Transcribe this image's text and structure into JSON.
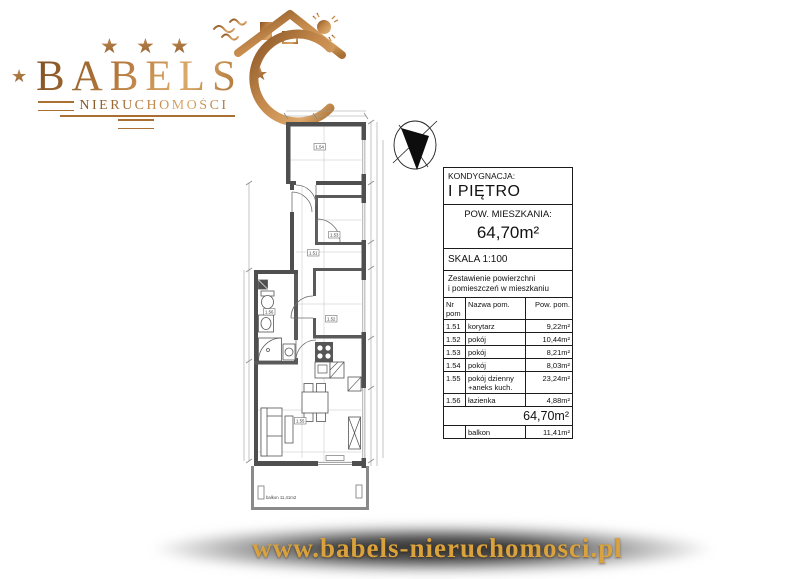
{
  "logo": {
    "brand": "BABELS",
    "subtitle": "NIERUCHOMOŚCI",
    "star": "★"
  },
  "info_panel": {
    "kondygnacja_label": "KONDYGNACJA:",
    "kondygnacja_value": "I PIĘTRO",
    "pow_label": "POW. MIESZKANIA:",
    "pow_value": "64,70m²",
    "skala": "SKALA 1:100",
    "zestawienie_line1": "Zestawienie powierzchni",
    "zestawienie_line2": "i pomieszczeń w mieszkaniu",
    "table": {
      "headers": [
        "Nr pom",
        "Nazwa pom.",
        "Pow. pom."
      ],
      "rows": [
        {
          "nr": "1.51",
          "nazwa": "korytarz",
          "pow": "9,22m²"
        },
        {
          "nr": "1.52",
          "nazwa": "pokój",
          "pow": "10,44m²"
        },
        {
          "nr": "1.53",
          "nazwa": "pokój",
          "pow": "8,21m²"
        },
        {
          "nr": "1.54",
          "nazwa": "pokój",
          "pow": "8,03m²"
        },
        {
          "nr": "1.55",
          "nazwa": "pokój dzienny\n+aneks kuch.",
          "pow": "23,24m²"
        },
        {
          "nr": "1.56",
          "nazwa": "łazienka",
          "pow": "4,88m²"
        }
      ],
      "total": "64,70m²",
      "balkon_row": {
        "nr": "",
        "nazwa": "balkon",
        "pow": "11,41m²"
      }
    }
  },
  "plan": {
    "labels": {
      "room_top": "1.54",
      "room_153": "1.53",
      "corridor": "1.51",
      "room_152": "1.52",
      "bathroom": "1.56",
      "living": "1.55"
    },
    "balkon_label": "balkon 11,41m2"
  },
  "footer": {
    "url": "www.babels-nieruchomosci.pl"
  },
  "colors": {
    "gold": "#b5793c",
    "wall": "#4f4f4f",
    "footer_text": "#d9a23c"
  }
}
